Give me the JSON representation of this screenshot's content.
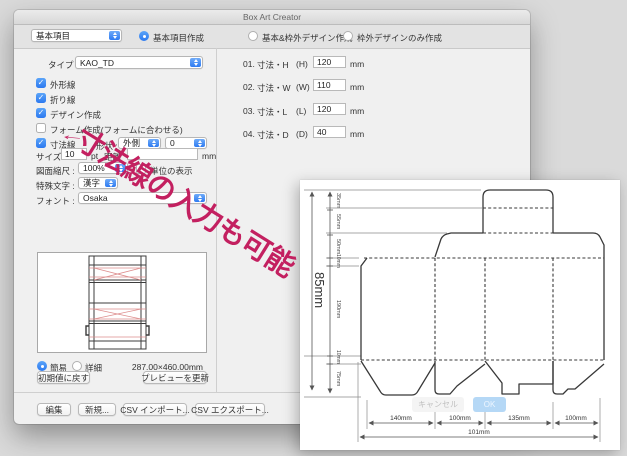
{
  "window": {
    "title": "Box Art Creator"
  },
  "toolbar": {
    "preset_value": "基本項目",
    "radio_basic": "基本項目作成",
    "radio_both": "基本&枠外デザイン作成",
    "radio_outer_only": "枠外デザインのみ作成"
  },
  "form": {
    "type_label": "タイプ :",
    "type_value": "KAO_TD",
    "checkboxes": [
      {
        "label": "外形線",
        "checked": true
      },
      {
        "label": "折り線",
        "checked": true
      },
      {
        "label": "デザイン作成",
        "checked": true
      },
      {
        "label": "フォーム作成(フォームに合わせる)",
        "checked": false
      },
      {
        "label": "寸法線",
        "checked": true
      }
    ],
    "shape_label": "形状 :",
    "shape_value": "外側",
    "offset_value": "0",
    "size_label": "サイズ",
    "size_value": "10",
    "size_unit": "pt",
    "distance_label": "距離",
    "distance_value": "",
    "distance_unit": "mm",
    "scale_label": "図面縮尺 :",
    "scale_value": "100%",
    "unit_display_label": "単位の表示",
    "special_label": "特殊文字 :",
    "special_value": "漢字",
    "font_label": "フォント :",
    "font_value": "Osaka",
    "mode_simple": "簡易",
    "mode_detail": "詳細",
    "preview_size": "287.00×460.00mm",
    "reset_button": "初期値に戻す",
    "update_button": "プレビューを更新"
  },
  "dimensions": {
    "rows": [
      {
        "no": "01.",
        "name": "寸法・H",
        "axis": "(H)",
        "value": "120",
        "unit": "mm"
      },
      {
        "no": "02.",
        "name": "寸法・W",
        "axis": "(W)",
        "value": "110",
        "unit": "mm"
      },
      {
        "no": "03.",
        "name": "寸法・L",
        "axis": "(L)",
        "value": "120",
        "unit": "mm"
      },
      {
        "no": "04.",
        "name": "寸法・D",
        "axis": "(D)",
        "value": "40",
        "unit": "mm"
      }
    ]
  },
  "footer": {
    "edit": "編集",
    "new": "新規...",
    "csv_import": "CSV インポート...",
    "csv_export": "CSV エクスポート..."
  },
  "annotation": {
    "arrow": "←",
    "text": "寸法線の入力も可能",
    "color": "#c32060"
  },
  "dieline_panel": {
    "cancel_button": "キャンセル",
    "ok_button": "OK",
    "overall_height": "85mm",
    "overall_width": "101mm",
    "height_segments": [
      "35mm",
      "55mm",
      "50mm",
      "10mm",
      "190mm",
      "10mm",
      "75mm"
    ],
    "width_segments": [
      "140mm",
      "100mm",
      "135mm",
      "100mm"
    ]
  }
}
